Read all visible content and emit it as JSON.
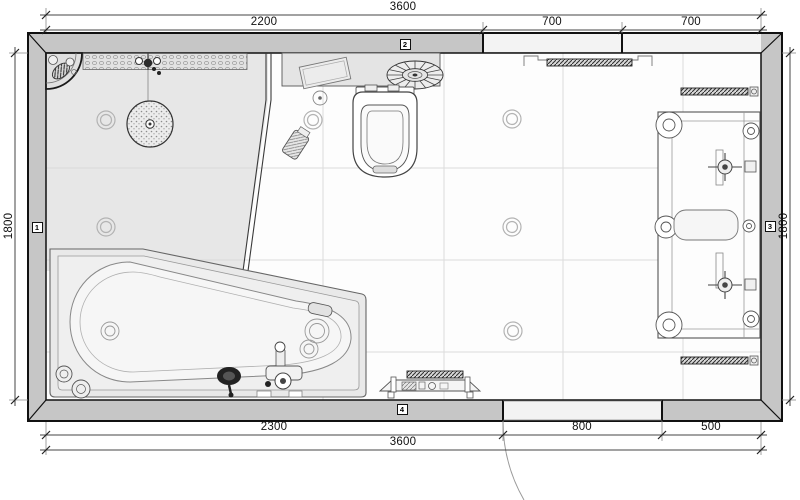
{
  "plan": {
    "dimensions": {
      "top_total": "3600",
      "top_segments": [
        "2200",
        "700",
        "700"
      ],
      "left_height": "1800",
      "right_height": "1800",
      "bottom_segments": [
        "2300",
        "800",
        "500"
      ],
      "bottom_total": "3600"
    },
    "wall_markers": [
      "1",
      "2",
      "3",
      "4"
    ],
    "colors": {
      "wall_fill": "#c6c6c6",
      "opening_fill": "#f3f3f3",
      "shower_floor": "#e7e7e7",
      "ledge_fill": "#e4e4e4",
      "tub_shell": "#e9e9e9",
      "outline": "#111111",
      "fixture_line": "#555555",
      "grid_line": "#d9d9d9",
      "dim_color": "#111111"
    },
    "fixtures": [
      "corner-shelf",
      "tiled-niche",
      "shower-mixer",
      "rain-shower-head",
      "glass-screen",
      "ledge-shelf",
      "tray",
      "decorative-fan",
      "wall-hung-toilet",
      "toilet-bin",
      "floor-drain",
      "ceiling-spotlight",
      "corner-bathtub",
      "bath-mixer",
      "hand-shower",
      "bath-drain",
      "towel-radiator",
      "towel-rail",
      "double-washstand",
      "bench",
      "door-swing"
    ]
  }
}
